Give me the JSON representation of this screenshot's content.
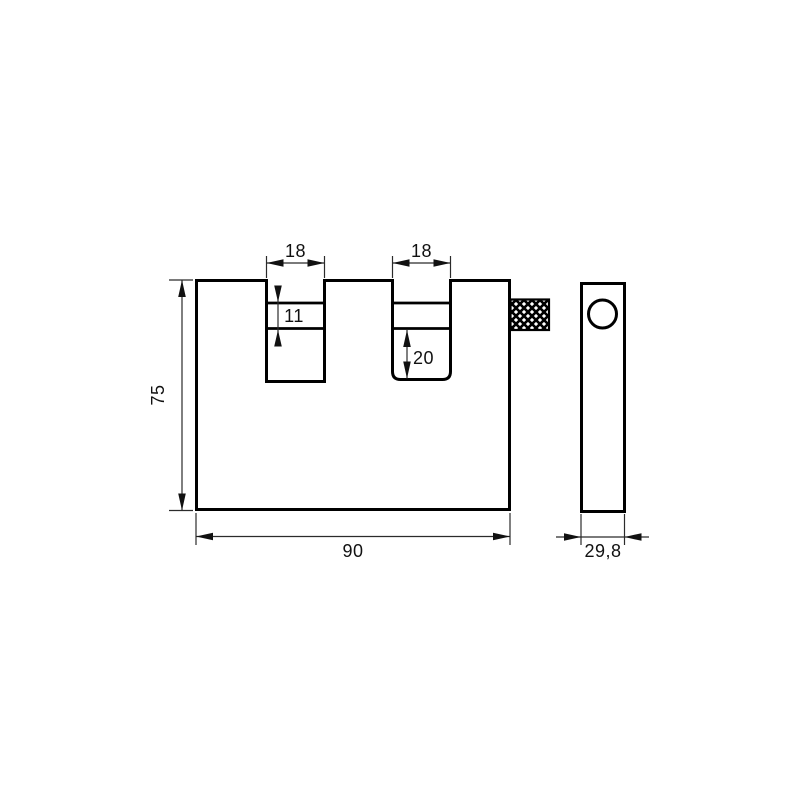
{
  "drawing": {
    "background_color": "#ffffff",
    "outline_color": "#000000",
    "dimension_line_color": "#2b2b2b",
    "dimensions": {
      "left_slot_width": "18",
      "right_slot_width": "18",
      "left_slot_band_height": "11",
      "right_slot_depth": "20",
      "body_height": "75",
      "body_width": "90",
      "side_width": "29,8"
    }
  }
}
